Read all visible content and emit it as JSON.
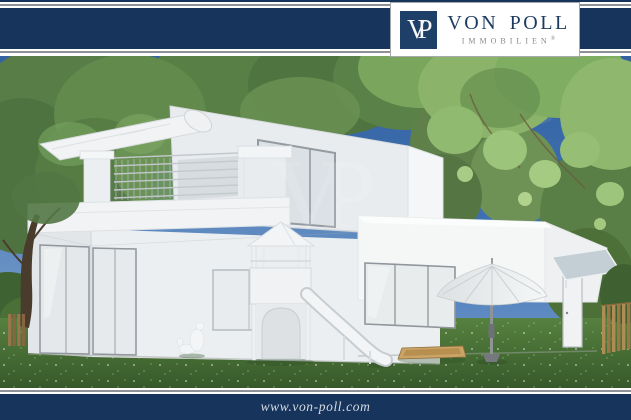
{
  "brand": {
    "monogram": "VP",
    "name": "VON POLL",
    "subtitle": "IMMOBILIEN",
    "registered": "®"
  },
  "watermark": {
    "text": "VP"
  },
  "footer": {
    "url": "www.von-poll.com"
  },
  "colors": {
    "frame_navy": "#17345c",
    "monogram_navy": "#1e4068",
    "frame_line_gray": "#8e9296",
    "sky_blue": "#3a6db4",
    "foliage_green": "#5d8449",
    "grass_green": "#46702f",
    "house_white": "#f2f4f5"
  },
  "scene": {
    "alt": "3D rendering of a modern white flat-roof house with roof terrace, awning, playground tower with slide, parasol, sandbox, garden lawn and trees"
  }
}
